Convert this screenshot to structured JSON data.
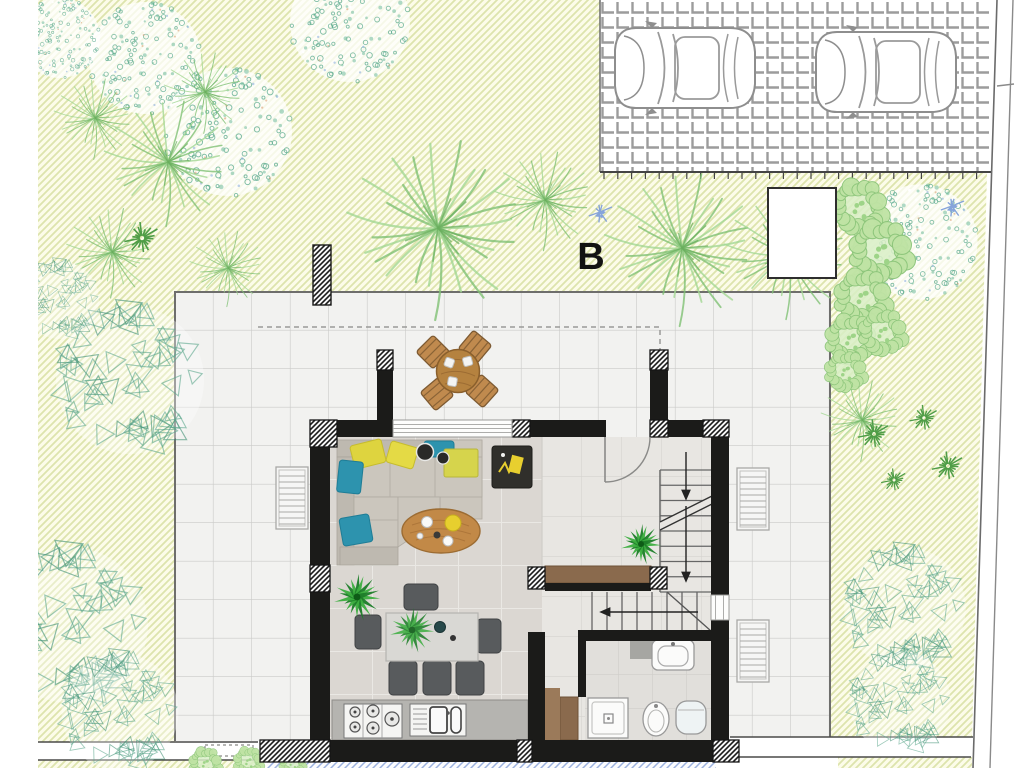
{
  "labels": {
    "building": "B"
  },
  "palette": {
    "garden_hatch": "#dde4ad",
    "garden_bg": "#fcfce9",
    "tree_teal": "#57a88b",
    "tree_green": "#8fcf7f",
    "wall": "#1b1b19",
    "patio_tile": "#f2f2f0",
    "living_tile": "#dbd7d2",
    "water_hatch": "#9cb1de",
    "wood": "#8a6a4d",
    "sofa": "#cbc6bd",
    "pillow_yellow": "#ded43f",
    "pillow_teal": "#2d93ae",
    "chair_gray": "#585b5d",
    "car_outline": "#8e8e8e"
  },
  "garden": {
    "trees": [
      {
        "t": "canopy",
        "x": 145,
        "y": 58,
        "s": 0.7
      },
      {
        "t": "canopy",
        "x": 350,
        "y": 22,
        "s": 0.75
      },
      {
        "t": "canopy",
        "x": 228,
        "y": 132,
        "s": 0.8
      },
      {
        "t": "canopy",
        "x": 920,
        "y": 242,
        "s": 0.72
      },
      {
        "t": "canopy",
        "x": 60,
        "y": 38,
        "s": 0.5
      },
      {
        "t": "palm",
        "x": 95,
        "y": 118,
        "s": 0.45
      },
      {
        "t": "palm",
        "x": 168,
        "y": 162,
        "s": 0.7
      },
      {
        "t": "palm",
        "x": 205,
        "y": 92,
        "s": 0.45
      },
      {
        "t": "palm",
        "x": 112,
        "y": 252,
        "s": 0.5
      },
      {
        "t": "palm",
        "x": 228,
        "y": 268,
        "s": 0.42
      },
      {
        "t": "palm",
        "x": 438,
        "y": 228,
        "s": 1.0
      },
      {
        "t": "palm",
        "x": 545,
        "y": 200,
        "s": 0.55
      },
      {
        "t": "palm",
        "x": 682,
        "y": 248,
        "s": 0.85
      },
      {
        "t": "palm",
        "x": 788,
        "y": 255,
        "s": 0.7
      },
      {
        "t": "palm",
        "x": 862,
        "y": 420,
        "s": 0.45
      },
      {
        "t": "shrub",
        "x": 130,
        "y": 380,
        "s": 0.95
      },
      {
        "t": "shrub",
        "x": 70,
        "y": 625,
        "s": 1.0
      },
      {
        "t": "shrub",
        "x": 120,
        "y": 712,
        "s": 0.75
      },
      {
        "t": "shrub",
        "x": 905,
        "y": 608,
        "s": 0.78
      },
      {
        "t": "shrub",
        "x": 900,
        "y": 702,
        "s": 0.65
      },
      {
        "t": "shrub",
        "x": 60,
        "y": 300,
        "s": 0.5
      },
      {
        "t": "bush",
        "x": 858,
        "y": 208,
        "s": 0.95
      },
      {
        "t": "bush",
        "x": 880,
        "y": 252,
        "s": 1.05
      },
      {
        "t": "bush",
        "x": 862,
        "y": 298,
        "s": 0.95
      },
      {
        "t": "bush",
        "x": 850,
        "y": 340,
        "s": 0.85
      },
      {
        "t": "bush",
        "x": 882,
        "y": 333,
        "s": 0.8
      },
      {
        "t": "bush",
        "x": 845,
        "y": 372,
        "s": 0.7
      },
      {
        "t": "bush",
        "x": 205,
        "y": 764,
        "s": 0.55
      },
      {
        "t": "bush",
        "x": 248,
        "y": 762,
        "s": 0.5
      },
      {
        "t": "bush",
        "x": 292,
        "y": 763,
        "s": 0.45
      },
      {
        "t": "darkstar",
        "x": 874,
        "y": 434,
        "s": 1
      },
      {
        "t": "darkstar",
        "x": 924,
        "y": 418,
        "s": 0.9
      },
      {
        "t": "darkstar",
        "x": 948,
        "y": 466,
        "s": 1
      },
      {
        "t": "darkstar",
        "x": 894,
        "y": 480,
        "s": 0.8
      },
      {
        "t": "darkstar",
        "x": 142,
        "y": 238,
        "s": 1.1
      },
      {
        "t": "blue",
        "x": 600,
        "y": 212,
        "s": 1
      },
      {
        "t": "blue",
        "x": 952,
        "y": 206,
        "s": 1
      }
    ]
  },
  "parking": {
    "cars": [
      {
        "x": 612,
        "y": 24
      },
      {
        "x": 813,
        "y": 28
      }
    ]
  },
  "objects": [
    "corner-sofa",
    "coffee-table",
    "side-table",
    "dining-table",
    "dining-chairs",
    "kitchen-counter",
    "gas-hob",
    "kitchen-sink",
    "staircase",
    "bathroom-sink",
    "toilet",
    "bidet",
    "shower",
    "outdoor-dining-set",
    "parked-cars",
    "shed",
    "pool-edge",
    "roof-overhang",
    "garden-pillar"
  ]
}
